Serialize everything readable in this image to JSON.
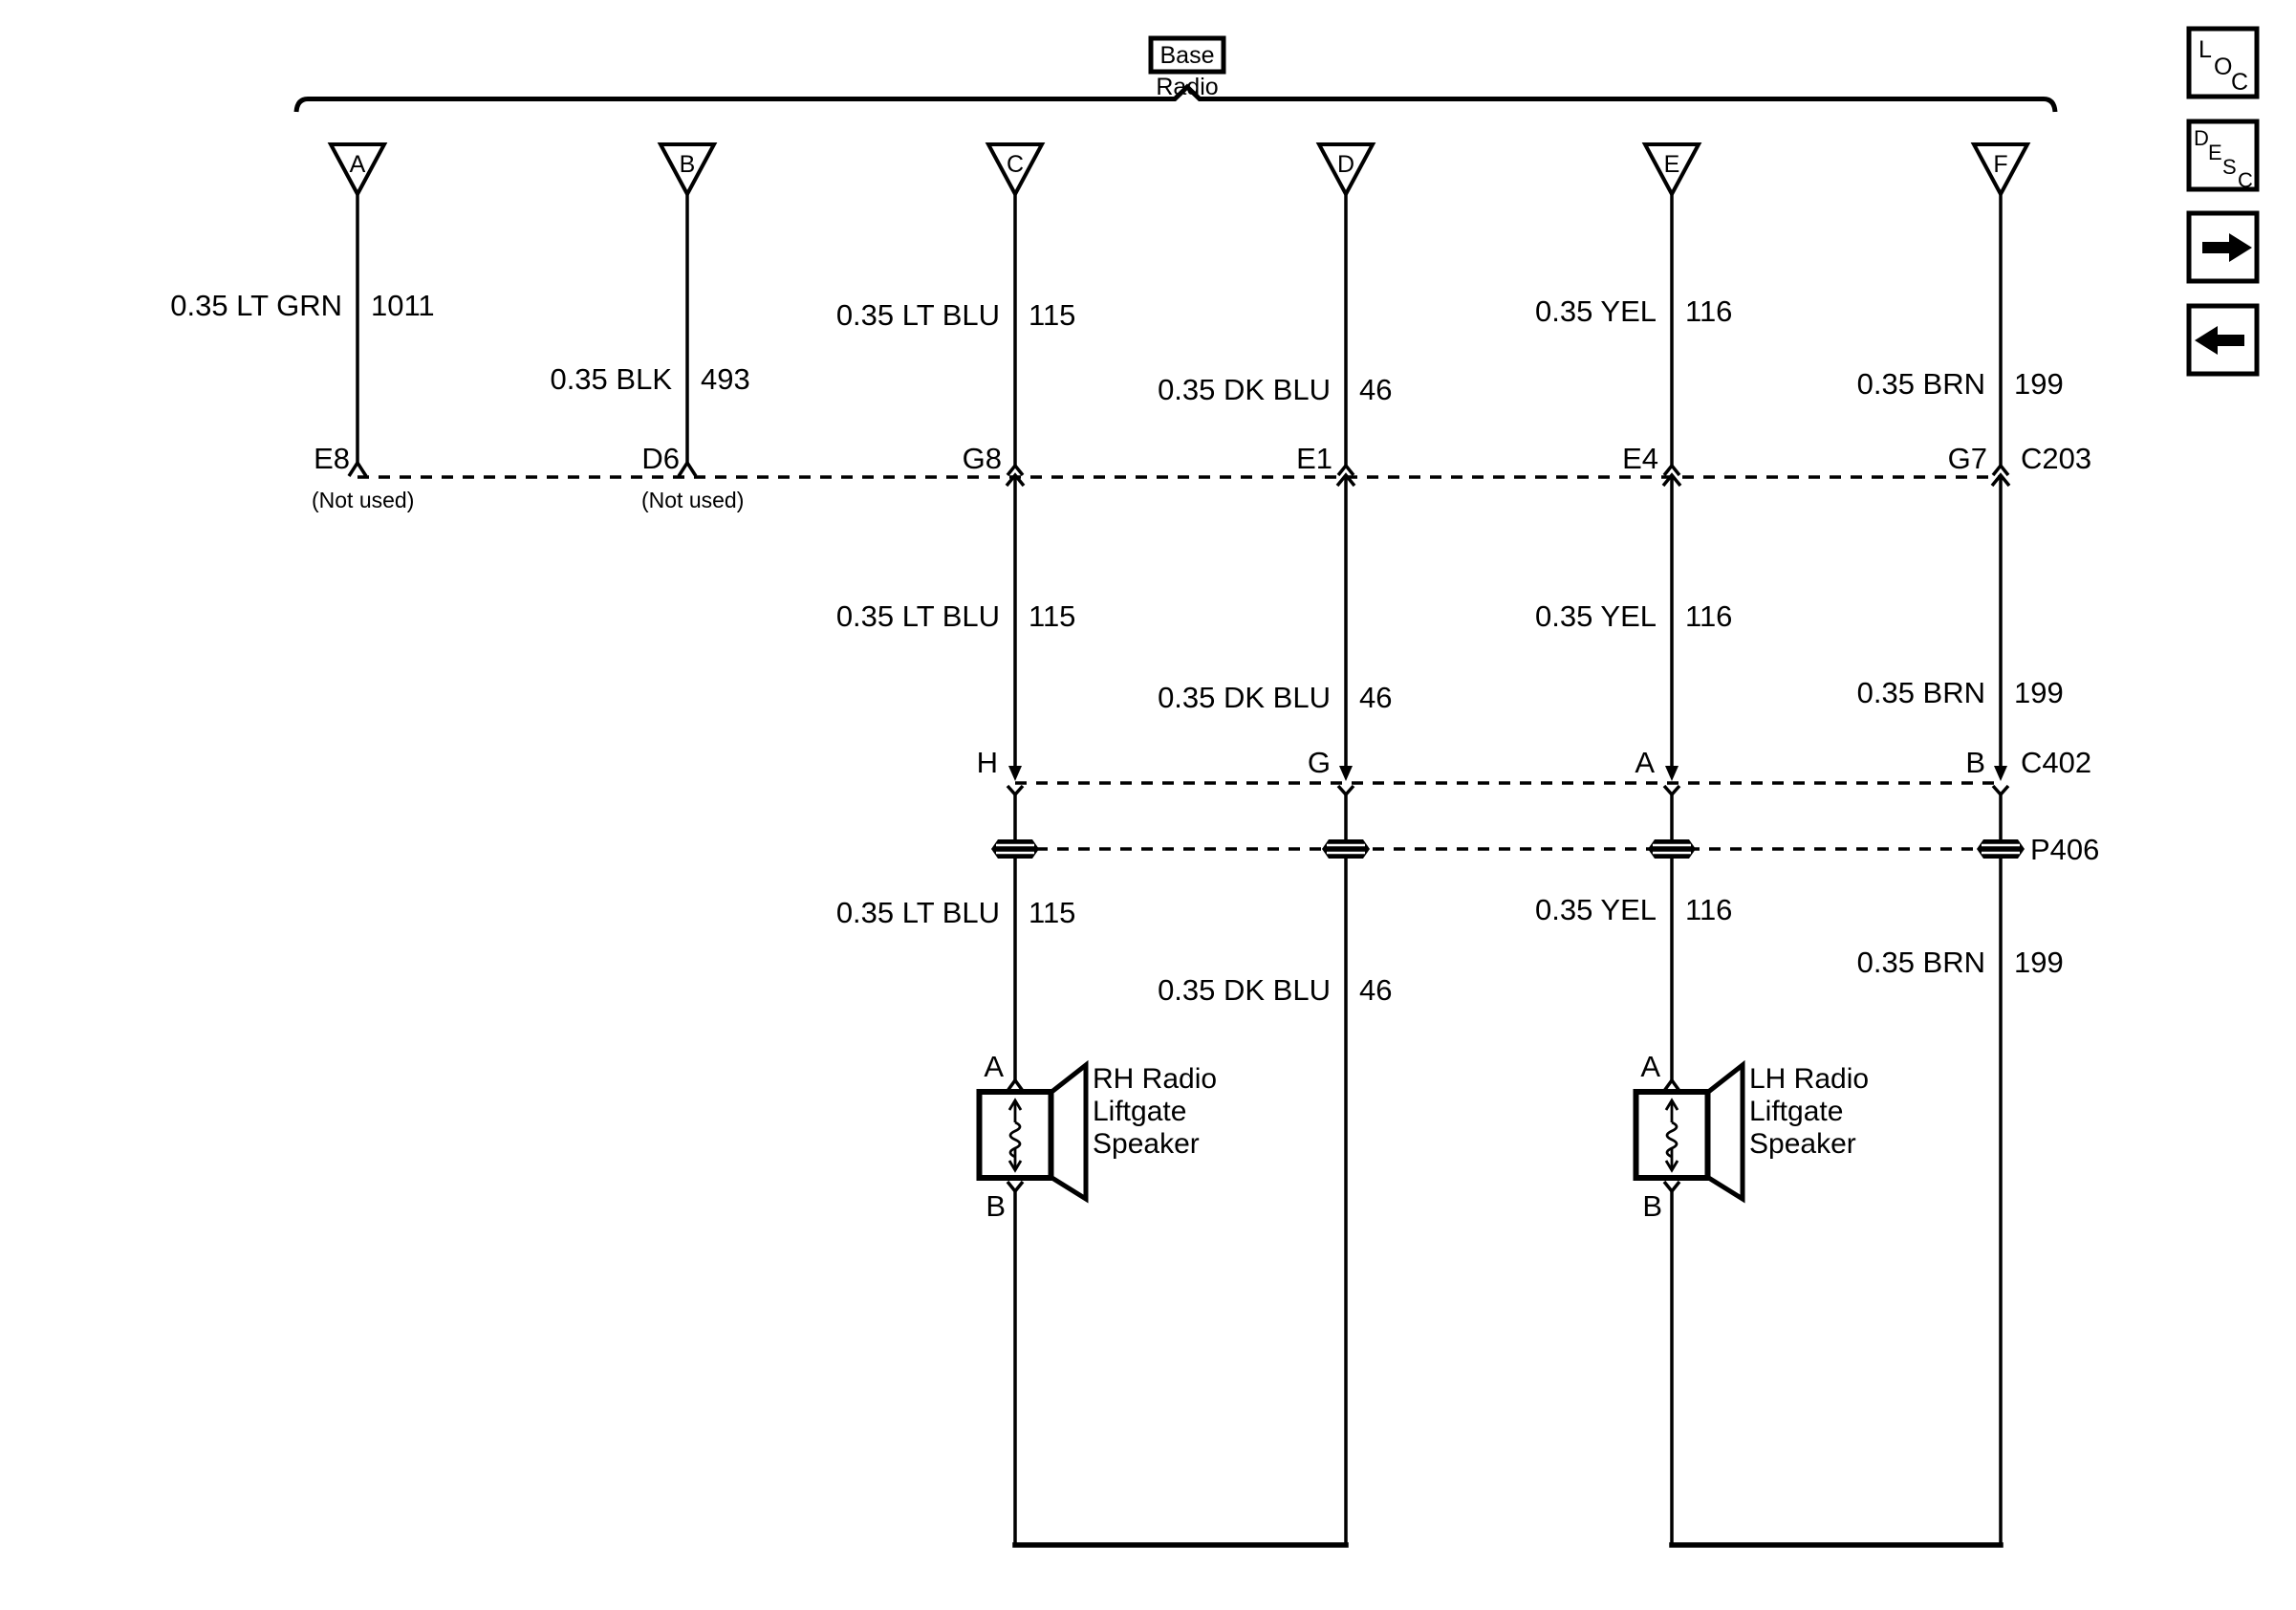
{
  "header": {
    "variant": "Base",
    "component": "Radio"
  },
  "branch_pins": [
    "A",
    "B",
    "C",
    "D",
    "E",
    "F"
  ],
  "wires": {
    "a": {
      "label": "0.35 LT GRN",
      "circuit": "1011",
      "c203_pin": "E8",
      "c203_note": "(Not used)"
    },
    "b": {
      "label": "0.35 BLK",
      "circuit": "493",
      "c203_pin": "D6",
      "c203_note": "(Not used)"
    },
    "c": {
      "label": "0.35 LT BLU",
      "circuit": "115",
      "c203_pin": "G8",
      "c402_pin": "H",
      "speaker_pin_top": "A",
      "speaker_pin_bottom": "B"
    },
    "d": {
      "label": "0.35 DK BLU",
      "circuit": "46",
      "c203_pin": "E1",
      "c402_pin": "G"
    },
    "e": {
      "label": "0.35 YEL",
      "circuit": "116",
      "c203_pin": "E4",
      "c402_pin": "A",
      "speaker_pin_top": "A",
      "speaker_pin_bottom": "B"
    },
    "f": {
      "label": "0.35 BRN",
      "circuit": "199",
      "c203_pin": "G7",
      "c402_pin": "B"
    }
  },
  "connectors": {
    "row1": "C203",
    "row2": "C402",
    "row3": "P406"
  },
  "speakers": {
    "rh": {
      "name_lines": [
        "RH Radio",
        "Liftgate",
        "Speaker"
      ]
    },
    "lh": {
      "name_lines": [
        "LH Radio",
        "Liftgate",
        "Speaker"
      ]
    }
  },
  "side_buttons": {
    "loc": {
      "letters": [
        "L",
        "O",
        "C"
      ]
    },
    "desc": {
      "letters": [
        "D",
        "E",
        "S",
        "C"
      ]
    },
    "forward_icon": "right-arrow",
    "back_icon": "left-arrow"
  },
  "colors": {
    "ink": "#000000",
    "paper": "#ffffff"
  }
}
